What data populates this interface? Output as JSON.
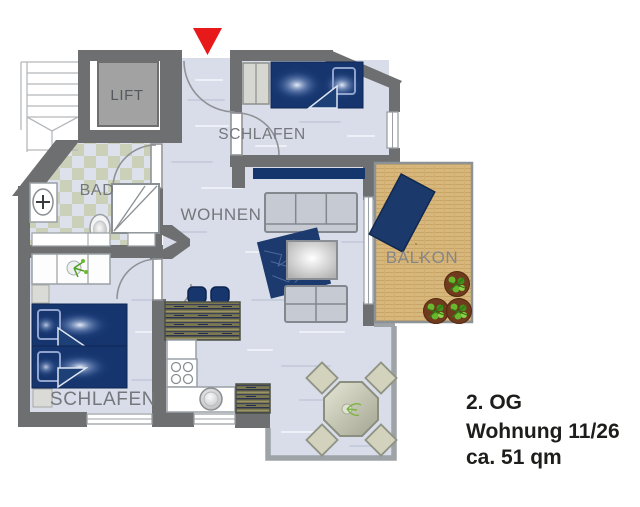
{
  "floor_plan": {
    "rooms": [
      {
        "id": "lift",
        "label": "LIFT"
      },
      {
        "id": "bad",
        "label": "BAD"
      },
      {
        "id": "wohnen",
        "label": "WOHNEN"
      },
      {
        "id": "schlafen_top",
        "label": "SCHLAFEN"
      },
      {
        "id": "schlafen_bottom",
        "label": "SCHLAFEN"
      },
      {
        "id": "balkon",
        "label": "BALKON"
      }
    ],
    "annotation": {
      "floor": "2. OG",
      "unit": "Wohnung 11/26",
      "area": "ca. 51 qm"
    },
    "colors": {
      "wall_dark": "#6d6f71",
      "floor": "#d9dde9",
      "bath_tile_accent": "#cbd1b9",
      "furniture_navy": "#16356e",
      "wood_deck": "#d8b77c",
      "entrance_arrow_red": "#e8191b",
      "label_gray": "#74777b",
      "plant_green": "#5fae2a",
      "terrace_wall_light": "#9ea3a7"
    }
  }
}
